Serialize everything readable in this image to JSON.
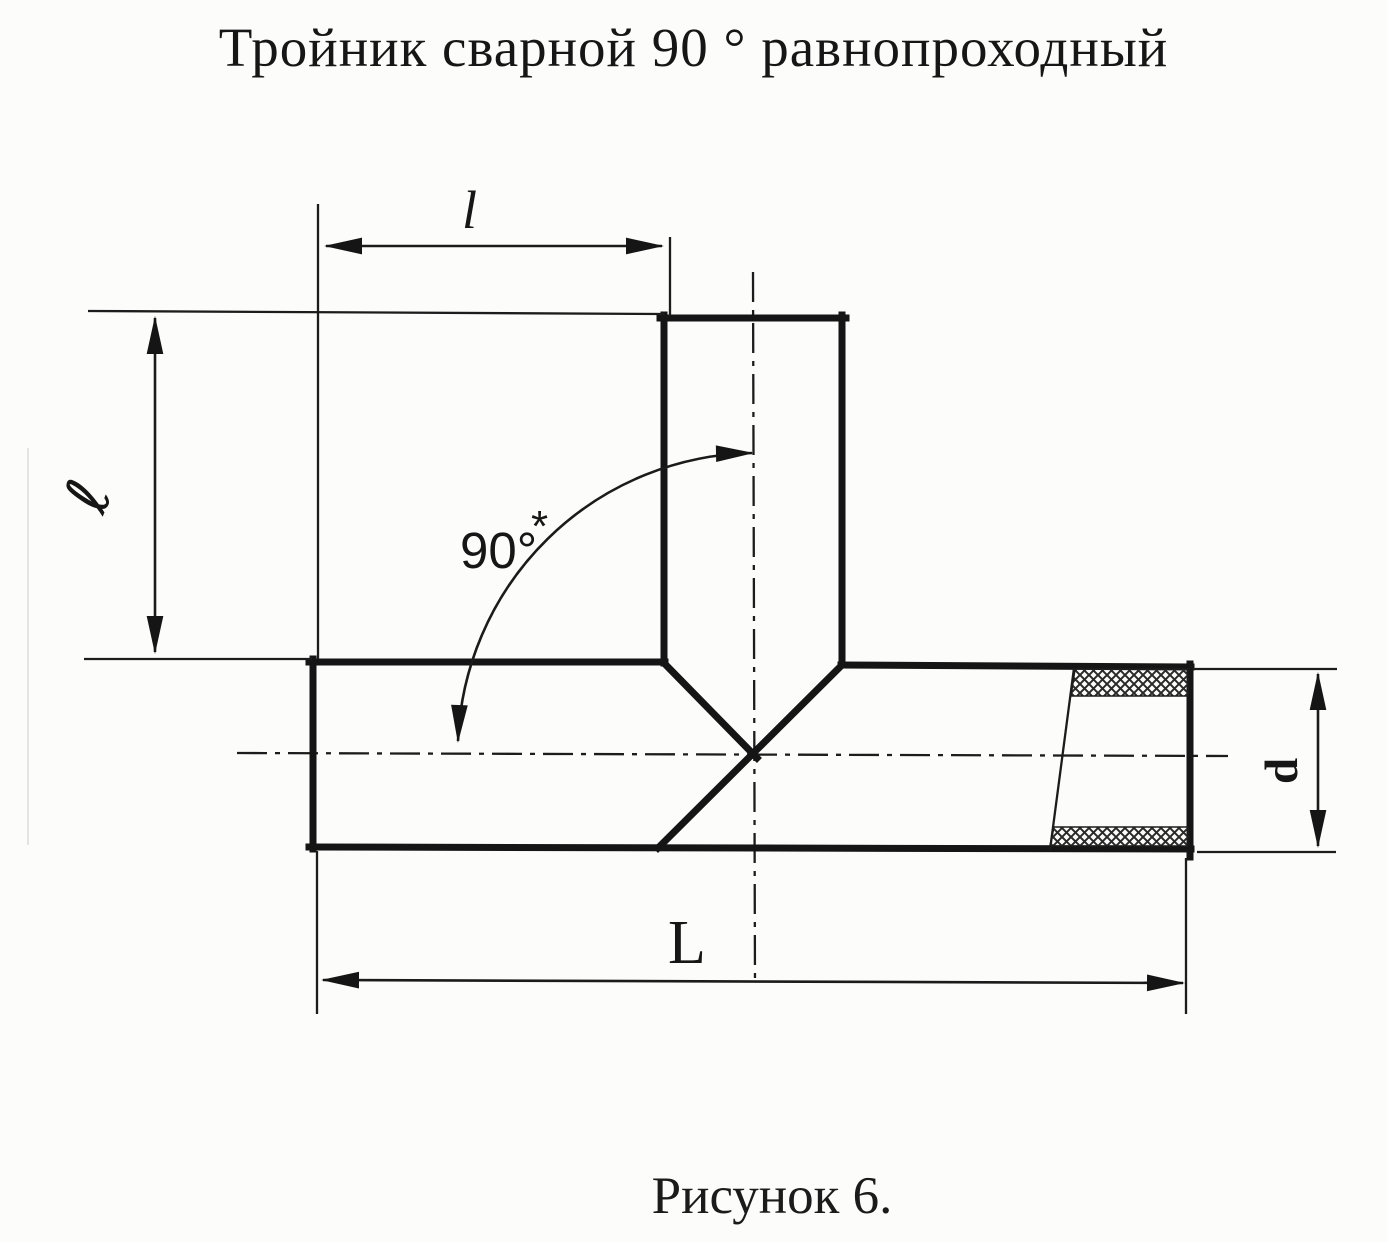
{
  "page": {
    "title": "Тройник сварной 90 ° равнопроходный",
    "caption": "Рисунок 6."
  },
  "drawing": {
    "type": "technical-diagram",
    "labels": {
      "branch_offset": "l",
      "branch_height": "ℓ",
      "angle": "90°",
      "angle_footnote": "*",
      "overall_length": "L",
      "diameter": "d"
    },
    "colors": {
      "ink": "#1a1a1a",
      "paper": "#fcfcfa"
    }
  }
}
